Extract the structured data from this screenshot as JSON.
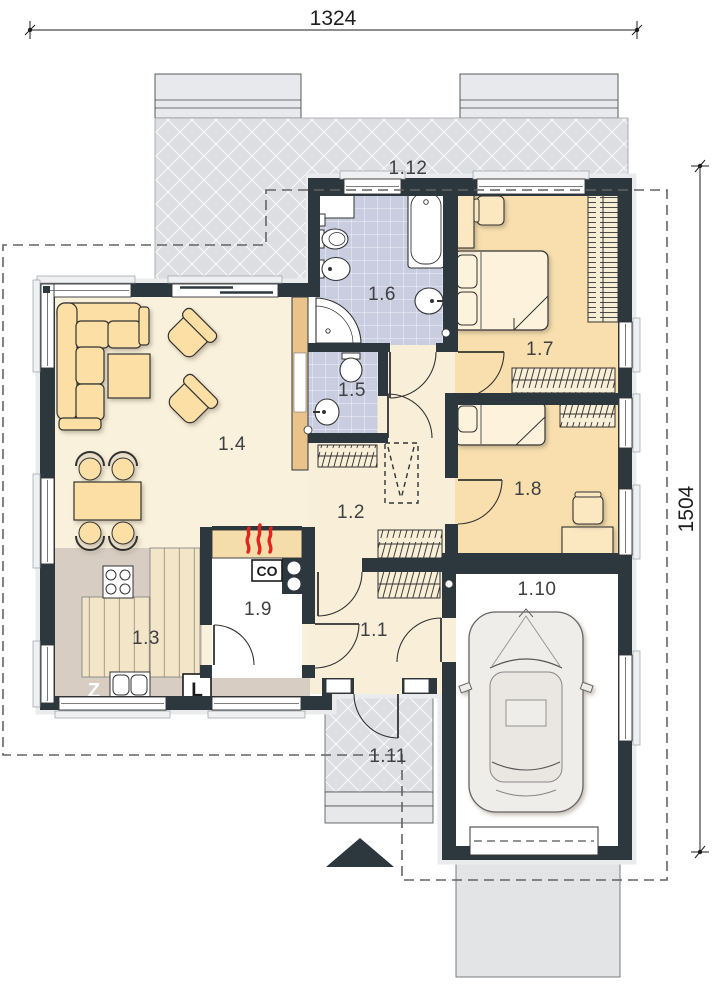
{
  "plan": {
    "type": "architectural-floor-plan",
    "dimensions": {
      "top": "1324",
      "right": "1504"
    },
    "rooms": [
      {
        "label": "1.1"
      },
      {
        "label": "1.2"
      },
      {
        "label": "1.3"
      },
      {
        "label": "1.4"
      },
      {
        "label": "1.5"
      },
      {
        "label": "1.6"
      },
      {
        "label": "1.7"
      },
      {
        "label": "1.8"
      },
      {
        "label": "1.9"
      },
      {
        "label": "1.10"
      },
      {
        "label": "1.11"
      },
      {
        "label": "1.12"
      }
    ],
    "labels": {
      "sink": "Z",
      "boiler": "CO",
      "fridge": "L"
    },
    "colors": {
      "wall": "#2d383e",
      "floor_main": "#faf1dc",
      "floor_bedroom": "#f8dfad",
      "floor_bathroom": "#c9cde0",
      "counter": "#d7cdc2",
      "wood": "#f3e6c8",
      "terrace": "#dcdee1",
      "furniture": "#fbdfa4",
      "heat_red": "#e0251f",
      "car": "#efede9",
      "accent_tan_wall": "#e9c389"
    }
  }
}
